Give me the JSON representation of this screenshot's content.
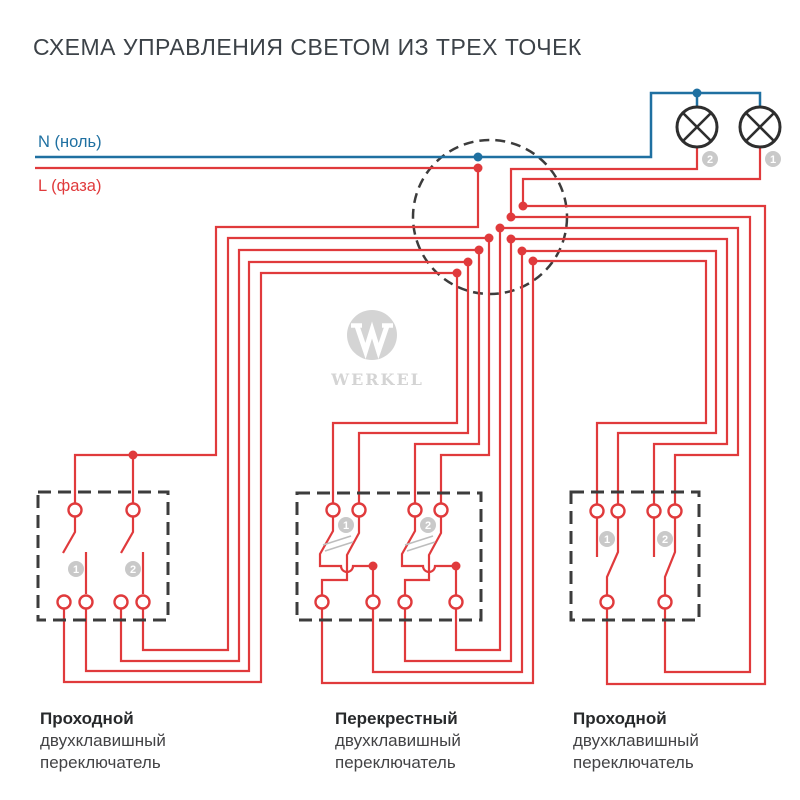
{
  "title": "СХЕМА УПРАВЛЕНИЯ СВЕТОМ ИЗ ТРЕХ ТОЧЕК",
  "wire_labels": {
    "neutral": "N (ноль)",
    "phase": "L (фаза)"
  },
  "lamps": {
    "lamp1_badge": "1",
    "lamp2_badge": "2"
  },
  "switches": [
    {
      "label_lines": [
        "Проходной",
        "двухклавишный",
        "переключатель"
      ],
      "key_badges": [
        "1",
        "2"
      ]
    },
    {
      "label_lines": [
        "Перекрестный",
        "двухклавишный",
        "переключатель"
      ],
      "key_badges": [
        "1",
        "2"
      ]
    },
    {
      "label_lines": [
        "Проходной",
        "двухклавишный",
        "переключатель"
      ],
      "key_badges": [
        "1",
        "2"
      ]
    }
  ],
  "watermark": {
    "brand": "WERKEL"
  },
  "colors": {
    "phase_red": "#e03a3c",
    "neutral_blue": "#1f70a1",
    "lamp_dark": "#2e2e2e",
    "box_dark": "#3c3c3c",
    "badge_gray": "#c9c9c9",
    "watermark_gray": "#d4d4d4",
    "title_color": "#3c4248",
    "label_bold": "#27292b",
    "label_gray": "#434345"
  }
}
